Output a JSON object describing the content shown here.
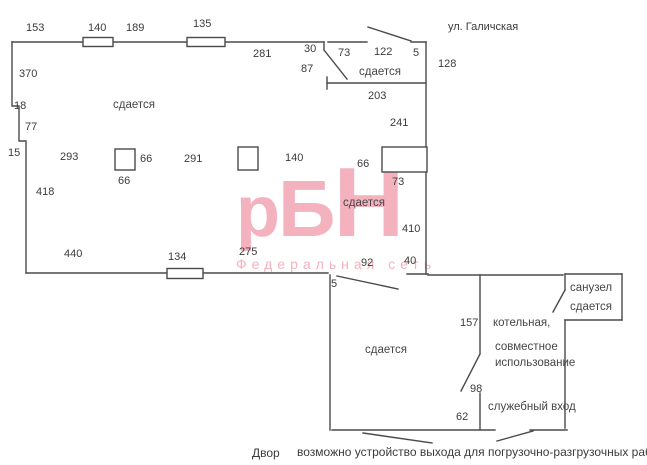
{
  "street": {
    "label": "ул. Галичская"
  },
  "watermark": {
    "logo_p": "р",
    "logo_b": "Б",
    "logo_n": "Н",
    "subtitle": "Федеральная сеть"
  },
  "rooms": {
    "main": "сдается",
    "vestibule": "сдается",
    "mid": "сдается",
    "lower": "сдается",
    "bathroom_name": "санузел",
    "bathroom_status": "сдается",
    "boiler_line1": "котельная,",
    "boiler_line2": "совместное",
    "boiler_line3": "использование",
    "service_entrance": "служебный вход"
  },
  "dims": {
    "top_153": "153",
    "top_140": "140",
    "top_189": "189",
    "top_135": "135",
    "top_281": "281",
    "top_30": "30",
    "vest_87": "87",
    "vest_73": "73",
    "vest_122": "122",
    "vest_5": "5",
    "vest_128": "128",
    "vest_203": "203",
    "right_241": "241",
    "niche_66": "66",
    "niche_73": "73",
    "right_410": "410",
    "left_370": "370",
    "left_18": "18",
    "left_77": "77",
    "left_15": "15",
    "left_418": "418",
    "col_293": "293",
    "col1_66_right": "66",
    "col1_66_below": "66",
    "col_291": "291",
    "col_140": "140",
    "bottom_440": "440",
    "bottom_134": "134",
    "bottom_275": "275",
    "open_92": "92",
    "open_40": "40",
    "open_5": "5",
    "boiler_157": "157",
    "boiler_98": "98",
    "boiler_62": "62"
  },
  "footer": {
    "yard": "Двор",
    "note": "возможно устройство выхода для погрузочно-разгрузочных работ"
  },
  "colors": {
    "line": "#4a4a4a",
    "text": "#3b3b3b",
    "watermark_pink": "#f4b2bf"
  }
}
